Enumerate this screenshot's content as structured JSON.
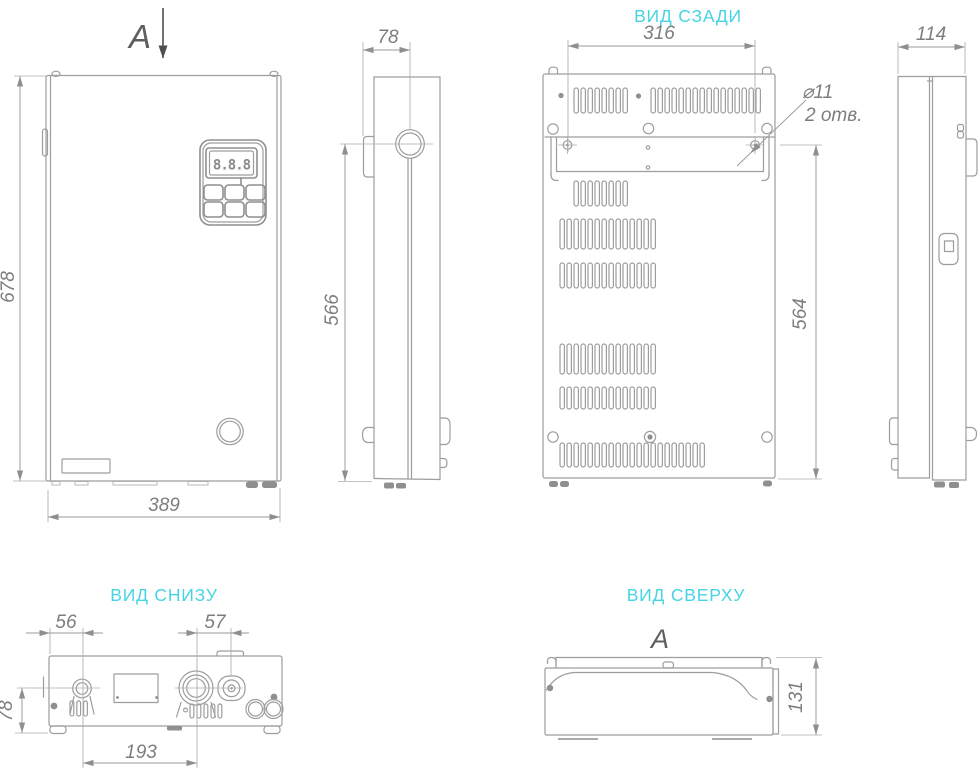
{
  "drawing": {
    "colors": {
      "line": "#9d9d9d",
      "dim_text": "#7d7d7d",
      "accent_title": "#46d4e4",
      "section_arrow": "#4f4f4f"
    },
    "views": {
      "front": {
        "section_label": "A",
        "dim_height": "678",
        "dim_width": "389",
        "display_value": "8.8.8"
      },
      "side_left": {
        "dim_depth": "78",
        "dim_pipe_height": "566"
      },
      "rear": {
        "title": "ВИД СЗАДИ",
        "dim_width": "316",
        "dim_height": "564",
        "hole_dia": "⌀11",
        "hole_count": "2 отв."
      },
      "side_right": {
        "dim_depth": "114"
      },
      "bottom": {
        "title": "ВИД СНИЗУ",
        "dim_left": "56",
        "dim_right": "57",
        "dim_depth": "78",
        "dim_span": "193"
      },
      "top": {
        "title": "ВИД СВЕРХУ",
        "section_label": "A",
        "dim_depth": "131"
      }
    }
  }
}
